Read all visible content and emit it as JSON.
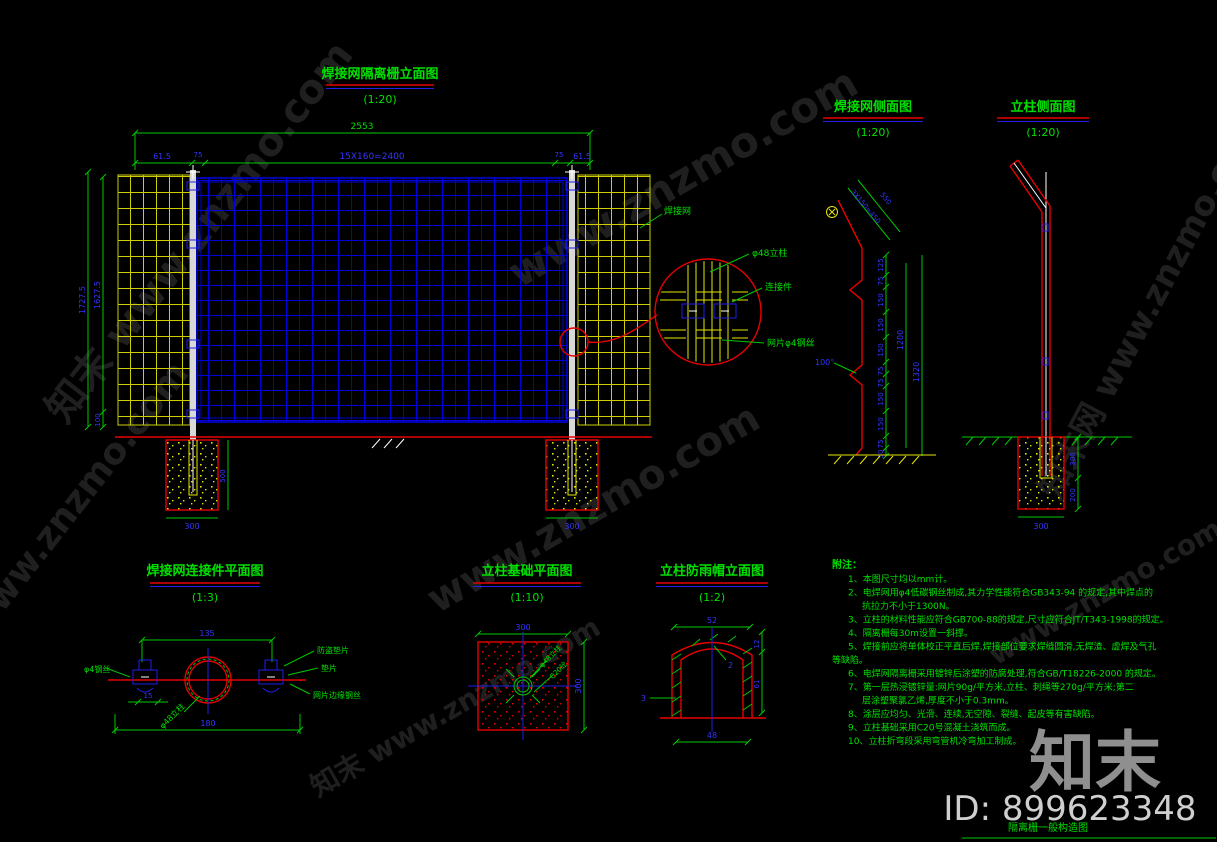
{
  "sheet": {
    "title": "隔离栅一般构造图",
    "id_label": "ID: 899623348",
    "logo_text": "知末",
    "watermark_text": "知末 www.znzmo.com",
    "watermark_text2": "www.znzmo.com",
    "watermark_text3": "知末网 www.znzmo.com"
  },
  "views": {
    "elevation": {
      "title": "焊接网隔离栅立面图",
      "scale": "(1:20)",
      "dim_total": "2553",
      "dim_chain": [
        "61.5",
        "75",
        "15X160=2400",
        "75",
        "61.5"
      ],
      "dim_left_outer": "1727.5",
      "dim_left_inner": "1627.5",
      "dim_left_bottom": "100",
      "dim_found_depth": "500",
      "dim_found_width": "300",
      "mesh_label": "焊接网",
      "detail_labels": {
        "post": "φ48立柱",
        "connector": "连接件",
        "wire": "网片φ4钢丝"
      }
    },
    "side": {
      "title": "焊接网侧面图",
      "scale": "(1:20)",
      "arm_dim_seg": "3X150=450",
      "arm_dim_total": "550",
      "angle_label": "100°",
      "chain": [
        "125",
        "75",
        "150",
        "150",
        "150",
        "75",
        "75",
        "150",
        "150",
        "75",
        "50"
      ],
      "overall_inner": "1200",
      "overall_outer": "1320"
    },
    "post_side": {
      "title": "立柱侧面图",
      "scale": "(1:20)",
      "dim_embed": "300",
      "dim_below": "200",
      "dim_width": "300"
    },
    "connector_plan": {
      "title": "焊接网连接件平面图",
      "scale": "(1:3)",
      "dim_top": "135",
      "dim_small": "15",
      "dim_bottom": "180",
      "labels": {
        "wire": "φ4钢丝",
        "anti_theft_washer": "防盗垫片",
        "washer": "垫片",
        "edge_wire": "网片边缘钢丝",
        "post": "φ48立柱"
      }
    },
    "foundation_plan": {
      "title": "立柱基础平面图",
      "scale": "(1:10)",
      "dim_top": "300",
      "dim_right": "300",
      "labels": {
        "post": "φ48立柱",
        "concrete": "C20砼"
      }
    },
    "rain_cap": {
      "title": "立柱防雨帽立面图",
      "scale": "(1:2)",
      "dim_top": "52",
      "dim_bottom": "48",
      "dim_wall": "3",
      "dim_right_upper": "12",
      "dim_right_lower": "61",
      "dim_thickness": "2"
    }
  },
  "notes": {
    "title": "附注：",
    "lines": [
      {
        "indent": 1,
        "text": "1、本图尺寸均以mm计。"
      },
      {
        "indent": 1,
        "text": "2、电焊网用φ4低碳钢丝制成,其力学性能符合GB343-94 的规定,其中焊点的"
      },
      {
        "indent": 2,
        "text": "抗拉力不小于1300N。"
      },
      {
        "indent": 1,
        "text": "3、立柱的材料性能应符合GB700-88的规定,尺寸应符合JT/T343-1998的规定。"
      },
      {
        "indent": 1,
        "text": "4、隔离栅每30m设置一斜撑。"
      },
      {
        "indent": 1,
        "text": "5、焊接前应将单体校正平直后焊,焊接部位要求焊缝圆滑,无焊渣、虚焊及气孔"
      },
      {
        "indent": 0,
        "text": "等缺陷。"
      },
      {
        "indent": 1,
        "text": "6、电焊网隔离栅采用镀锌后涂塑的防腐处理,符合GB/T18226-2000 的规定。"
      },
      {
        "indent": 1,
        "text": "7、第一层热浸镀锌量:网片90g/平方米,立柱、刺绳等270g/平方米;第二"
      },
      {
        "indent": 2,
        "text": "层涂塑聚氯乙烯,厚度不小于0.3mm。"
      },
      {
        "indent": 1,
        "text": "8、涂层应均匀、光滑、连续,无空隙、裂缝、起皮等有害缺陷。"
      },
      {
        "indent": 1,
        "text": "9、立柱基础采用C20号混凝土浇筑而成。"
      },
      {
        "indent": 1,
        "text": "10、立柱折弯段采用弯管机冷弯加工制成。"
      }
    ]
  }
}
